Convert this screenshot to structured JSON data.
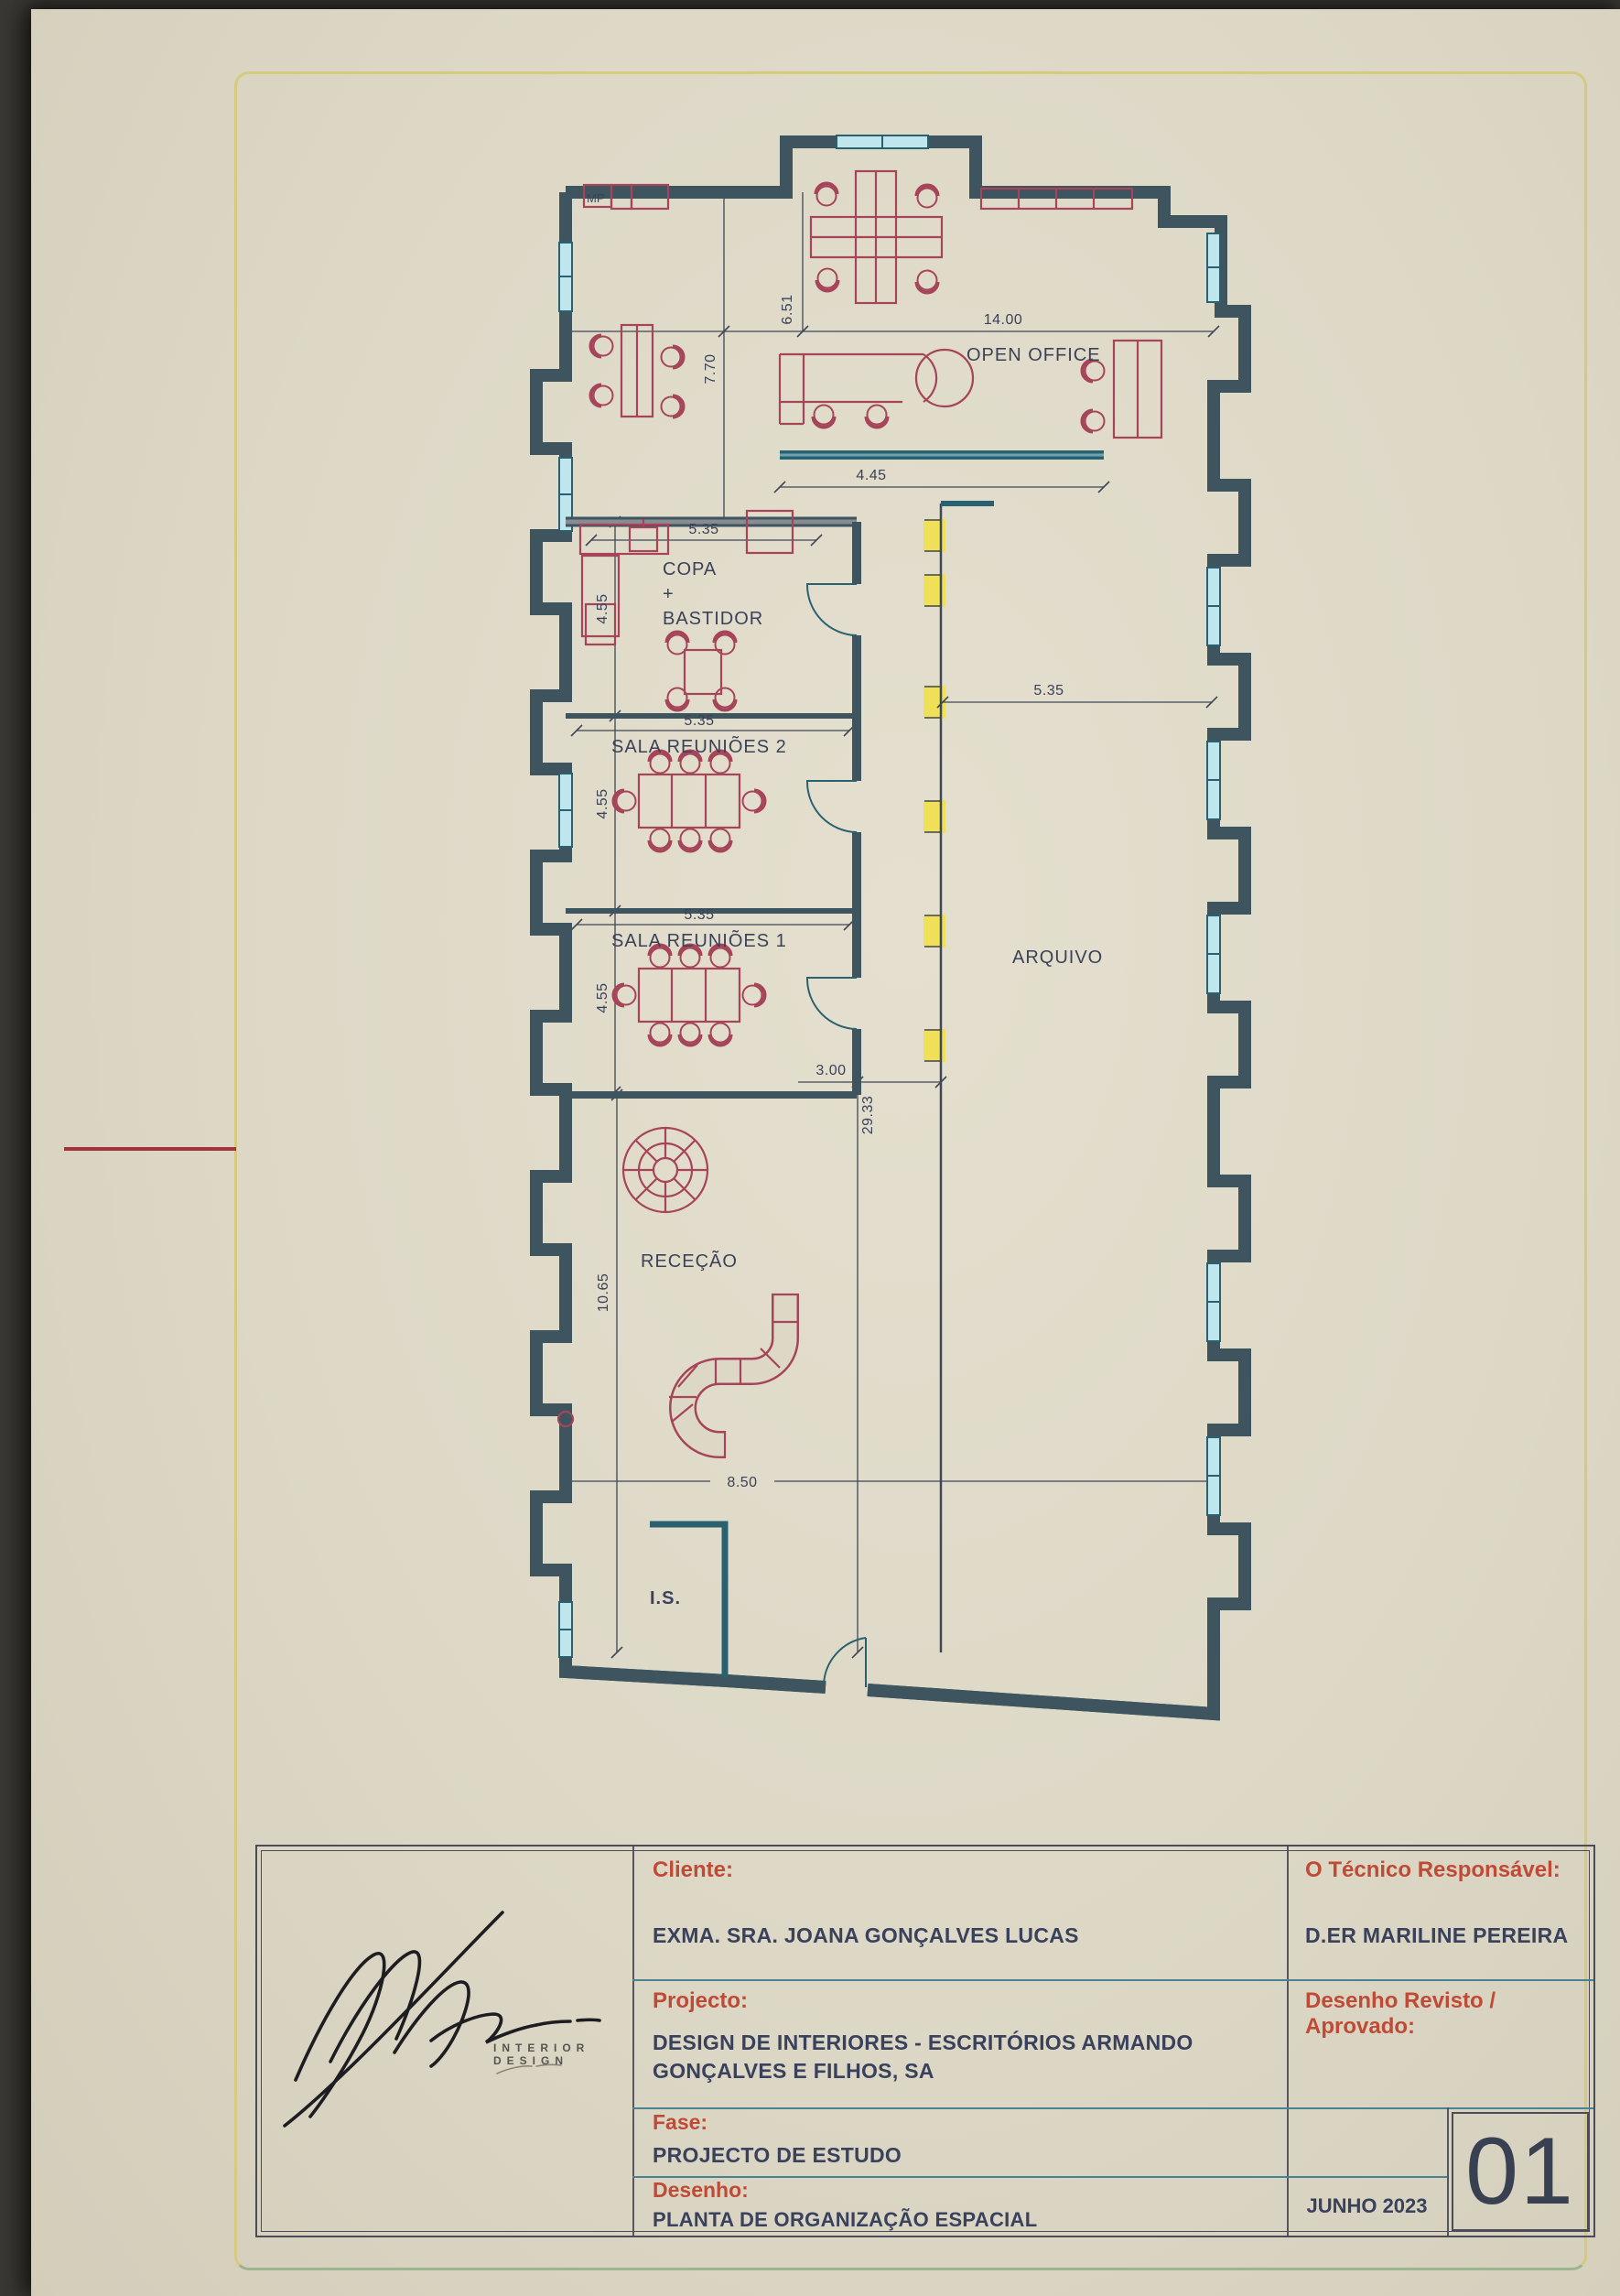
{
  "plan": {
    "room_labels": {
      "open_office": "OPEN OFFICE",
      "copa_line1": "COPA",
      "copa_line2": "+",
      "copa_line3": "BASTIDOR",
      "sala_reunioes_2": "SALA REUNIÕES 2",
      "sala_reunioes_1": "SALA REUNIÕES 1",
      "arquivo": "ARQUIVO",
      "rececao": "RECEÇÃO",
      "instalacao_sanitaria": "I.S.",
      "mp": "MP"
    },
    "dimensions": {
      "total_width": "14.00",
      "zone_a_depth": "6.51",
      "zone_b_depth": "7.70",
      "partition_width": "4.45",
      "copa_width": "5.35",
      "copa_depth": "4.55",
      "sala2_width": "5.35",
      "sala2_depth": "4.55",
      "sala1_width": "5.35",
      "sala1_depth": "4.55",
      "arquivo_width": "5.35",
      "corridor_width": "3.00",
      "total_length": "29.33",
      "rececao_depth": "10.65",
      "bottom_width": "8.50"
    }
  },
  "title_block": {
    "cliente_label": "Cliente:",
    "cliente_value": "EXMA. SRA. JOANA GONÇALVES LUCAS",
    "projecto_label": "Projecto:",
    "projecto_value": "DESIGN DE INTERIORES - ESCRITÓRIOS ARMANDO GONÇALVES E FILHOS, SA",
    "fase_label": "Fase:",
    "fase_value": "PROJECTO DE ESTUDO",
    "desenho_label": "Desenho:",
    "desenho_value": "PLANTA DE ORGANIZAÇÃO ESPACIAL",
    "tecnico_label": "O Técnico Responsável:",
    "tecnico_value": "D.ER MARILINE PEREIRA",
    "revisto_label": "Desenho Revisto / Aprovado:",
    "date": "JUNHO 2023",
    "sheet_number": "01",
    "logo_subtitle": "INTERIOR DESIGN"
  },
  "colors": {
    "paper": "#ddd8c6",
    "wall_dark": "#3e545e",
    "wall_fill": "#888b92",
    "teal_wall": "#2a6170",
    "window_fill": "#bfe6ec",
    "furniture": "#a64459",
    "highlight_yellow": "#f2e143",
    "border_yellow": "#d5ca7d",
    "border_green": "#9cb490",
    "label_red": "#bf4a35",
    "text_navy": "#39415c",
    "red_margin_line": "#a5313d"
  }
}
